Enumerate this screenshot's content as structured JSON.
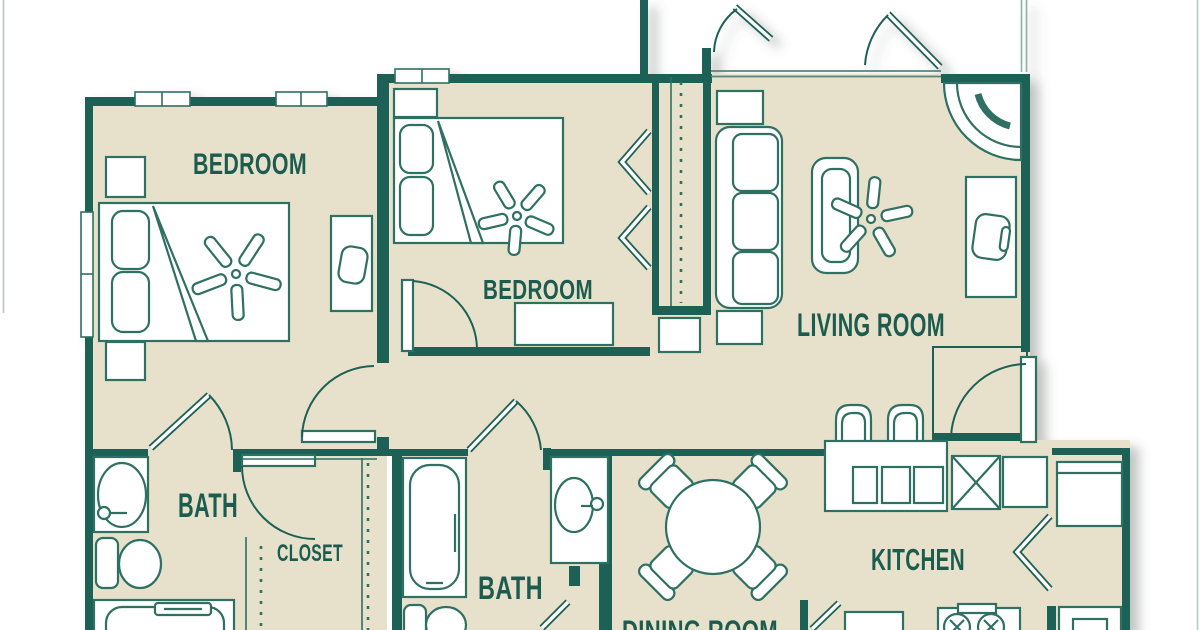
{
  "title": "Apartment floor plan",
  "rooms": {
    "bedroom_left": {
      "label": "BEDROOM"
    },
    "bedroom_middle": {
      "label": "BEDROOM"
    },
    "living_room": {
      "label": "LIVING ROOM"
    },
    "bath_left": {
      "label": "BATH"
    },
    "closet": {
      "label": "CLOSET"
    },
    "bath_middle": {
      "label": "BATH"
    },
    "dining_room": {
      "label": "DINING ROOM"
    },
    "kitchen": {
      "label": "KITCHEN"
    }
  },
  "colors": {
    "wall": "#1f6156",
    "floor": "#e7e1cb",
    "furniture_line": "#2d6f62",
    "label_text": "#1d5b50",
    "light_line": "#8fb0a8",
    "background": "#ffffff"
  }
}
